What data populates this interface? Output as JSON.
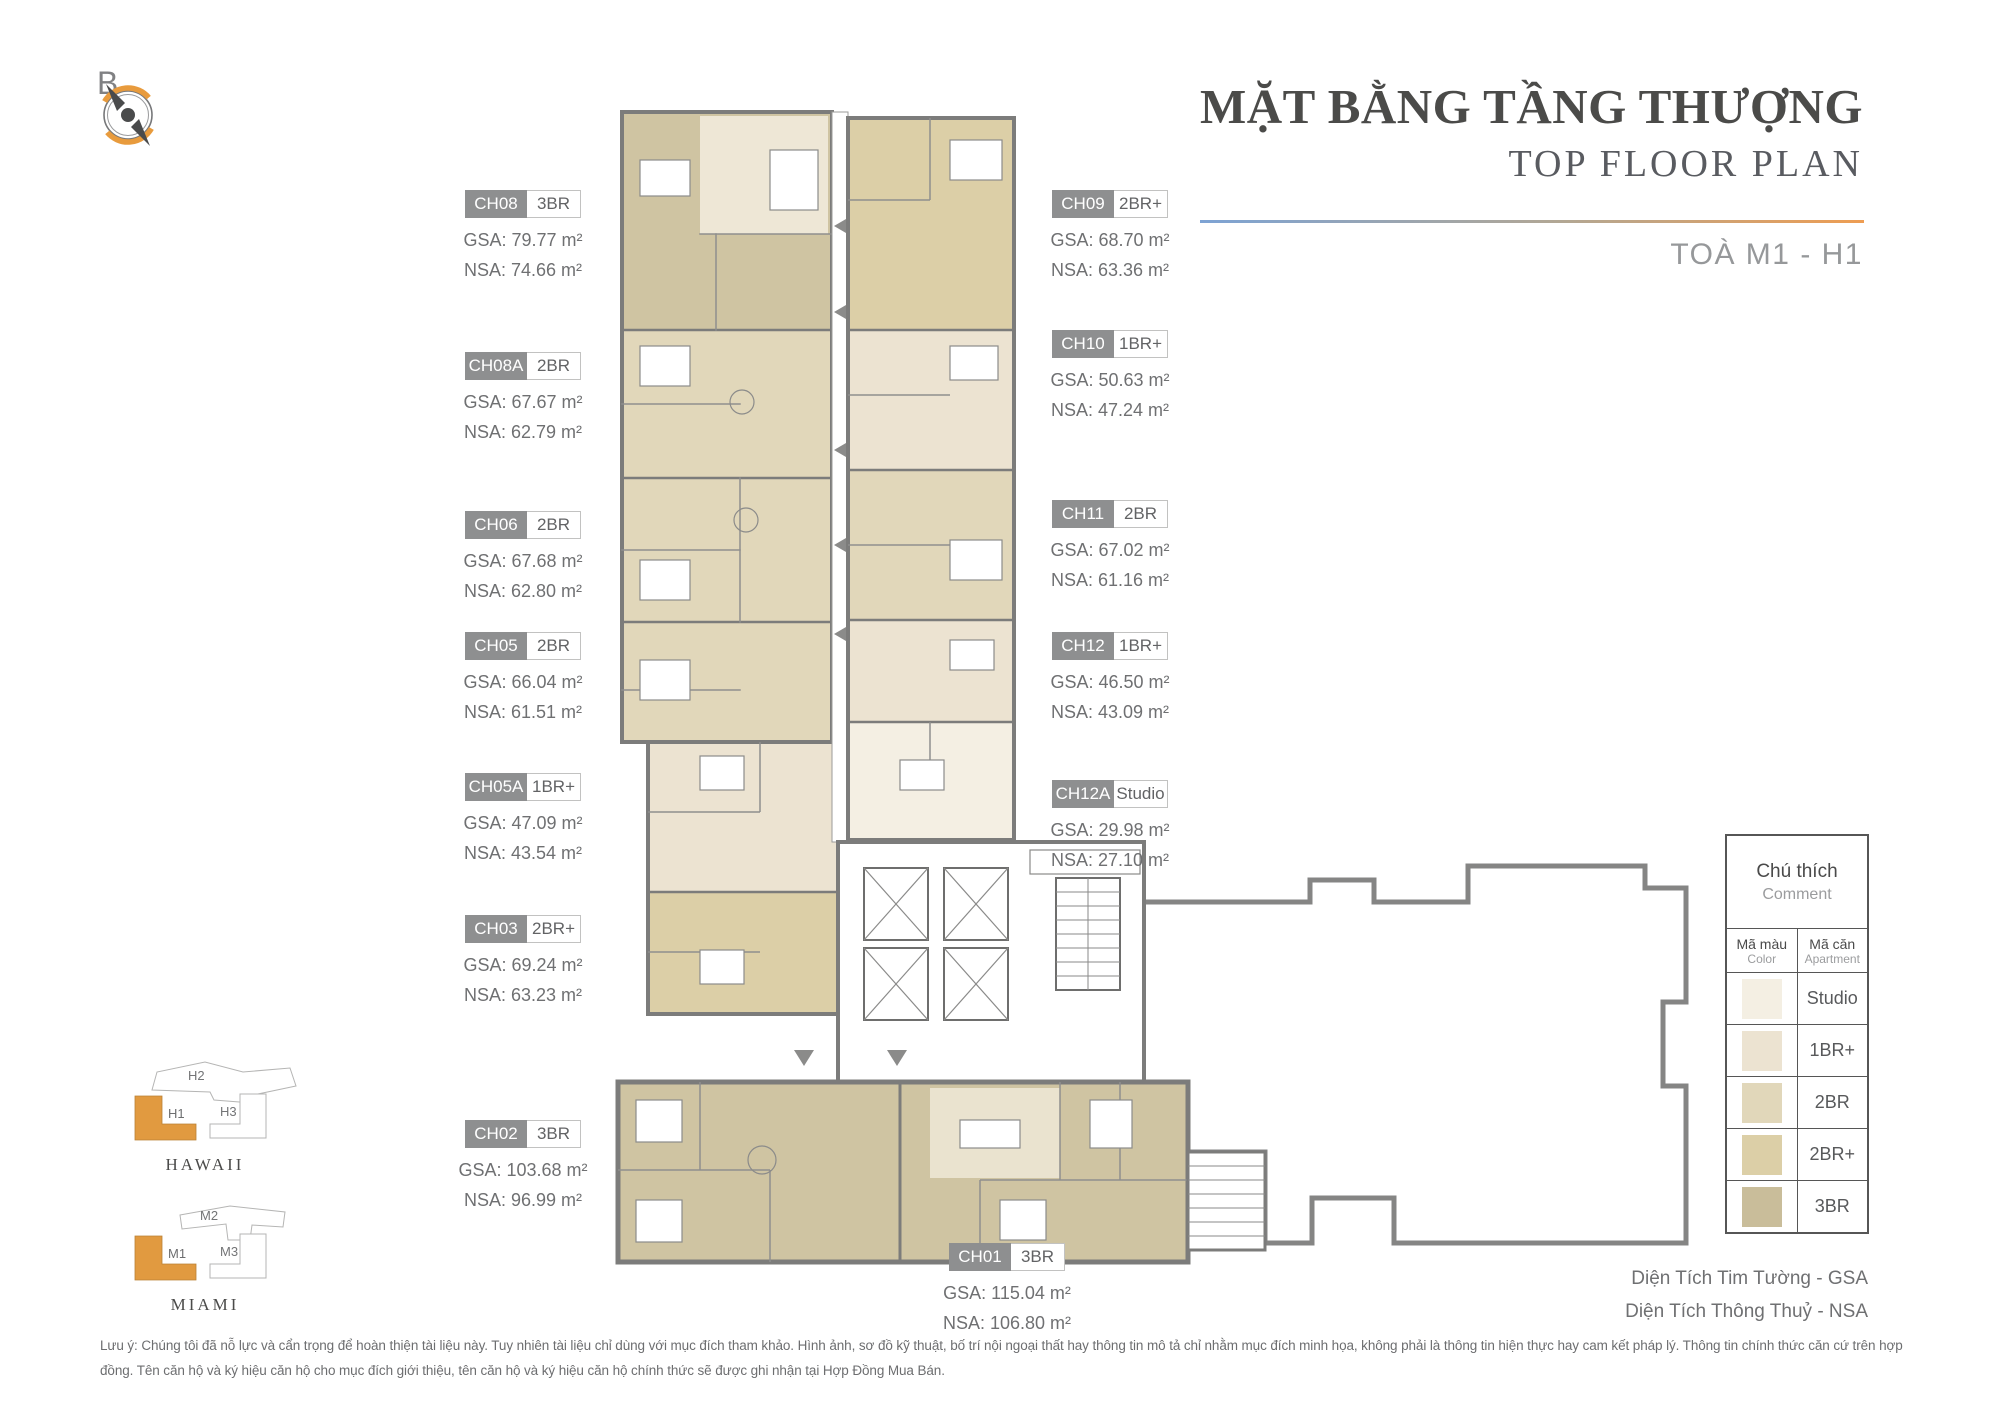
{
  "compass": {
    "label": "B"
  },
  "header": {
    "title": "MẶT BẰNG TẦNG THƯỢNG",
    "subtitle": "TOP FLOOR PLAN",
    "tower": "TOÀ M1 - H1"
  },
  "units": [
    {
      "code": "CH08",
      "type": "3BR",
      "gsa": "GSA: 79.77 m²",
      "nsa": "NSA: 74.66 m²"
    },
    {
      "code": "CH08A",
      "type": "2BR",
      "gsa": "GSA: 67.67 m²",
      "nsa": "NSA: 62.79 m²"
    },
    {
      "code": "CH06",
      "type": "2BR",
      "gsa": "GSA: 67.68 m²",
      "nsa": "NSA: 62.80 m²"
    },
    {
      "code": "CH05",
      "type": "2BR",
      "gsa": "GSA: 66.04 m²",
      "nsa": "NSA: 61.51 m²"
    },
    {
      "code": "CH05A",
      "type": "1BR+",
      "gsa": "GSA: 47.09 m²",
      "nsa": "NSA: 43.54 m²"
    },
    {
      "code": "CH03",
      "type": "2BR+",
      "gsa": "GSA: 69.24 m²",
      "nsa": "NSA: 63.23 m²"
    },
    {
      "code": "CH02",
      "type": "3BR",
      "gsa": "GSA: 103.68 m²",
      "nsa": "NSA: 96.99 m²"
    },
    {
      "code": "CH09",
      "type": "2BR+",
      "gsa": "GSA: 68.70 m²",
      "nsa": "NSA: 63.36 m²"
    },
    {
      "code": "CH10",
      "type": "1BR+",
      "gsa": "GSA: 50.63 m²",
      "nsa": "NSA: 47.24 m²"
    },
    {
      "code": "CH11",
      "type": "2BR",
      "gsa": "GSA: 67.02 m²",
      "nsa": "NSA: 61.16 m²"
    },
    {
      "code": "CH12",
      "type": "1BR+",
      "gsa": "GSA: 46.50 m²",
      "nsa": "NSA: 43.09 m²"
    },
    {
      "code": "CH12A",
      "type": "Studio",
      "gsa": "GSA: 29.98 m²",
      "nsa": "NSA: 27.10 m²"
    },
    {
      "code": "CH01",
      "type": "3BR",
      "gsa": "GSA: 115.04 m²",
      "nsa": "NSA: 106.80 m²"
    }
  ],
  "legend": {
    "title": "Chú thích",
    "subtitle": "Comment",
    "col_color_vi": "Mã màu",
    "col_color_en": "Color",
    "col_apt_vi": "Mã căn",
    "col_apt_en": "Apartment",
    "rows": [
      {
        "label": "Studio",
        "color": "#f4efe3"
      },
      {
        "label": "1BR+",
        "color": "#ece3d1"
      },
      {
        "label": "2BR",
        "color": "#e1d7ba"
      },
      {
        "label": "2BR+",
        "color": "#dccfa7"
      },
      {
        "label": "3BR",
        "color": "#c9bd9a"
      }
    ]
  },
  "minimap": {
    "hawaii_name": "HAWAII",
    "miami_name": "MIAMI",
    "highlight_color": "#e19a40",
    "labels": {
      "h1": "H1",
      "h2": "H2",
      "h3": "H3",
      "m1": "M1",
      "m2": "M2",
      "m3": "M3"
    }
  },
  "footer": {
    "gsa_note": "Diện Tích Tim Tường - GSA",
    "nsa_note": "Diện Tích Thông Thuỷ - NSA",
    "disclaimer": "Lưu ý: Chúng tôi đã nỗ lực và cẩn trọng để hoàn thiện tài liệu này. Tuy nhiên tài liệu chỉ dùng với mục đích tham khảo. Hình ảnh, sơ đồ kỹ thuật, bố trí nội ngoại thất hay thông tin mô tả chỉ nhằm mục đích minh họa, không phải là thông tin hiện thực hay cam kết pháp lý. Thông tin chính thức căn cứ trên hợp đồng. Tên căn hộ và ký hiệu căn hộ cho mục đích giới thiệu, tên căn hộ và ký hiệu căn hộ chính thức sẽ được ghi nhận tại Hợp Đồng Mua Bán."
  }
}
